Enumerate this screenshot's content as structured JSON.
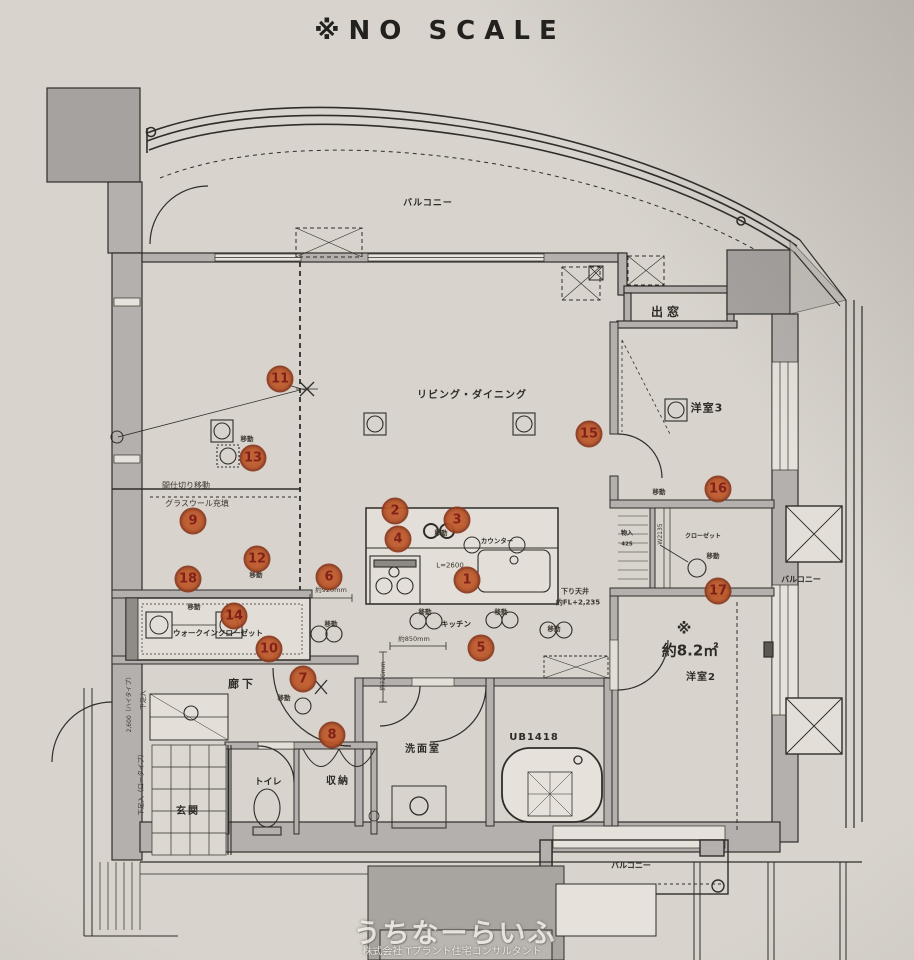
{
  "meta": {
    "scale_note": "※NO SCALE"
  },
  "colors": {
    "paper": "#d8d4cd",
    "line": "#2f2d29",
    "wall_fill": "#b4b0ad",
    "marker_fill": "#c05a2b",
    "marker_ring": "#8a3a1f",
    "marker_number": "#7a150d",
    "watermark_text": "#f0ede8"
  },
  "watermark": {
    "line1": "うちなーらいふ",
    "line2": "株式会社 Tプラント住宅コンサルタント"
  },
  "rooms": [
    {
      "id": "balcony-top",
      "text": "バルコニー",
      "x": 428,
      "y": 204,
      "fs": 9,
      "ls": 1
    },
    {
      "id": "living-dining",
      "text": "リビング・ダイニング",
      "x": 472,
      "y": 396,
      "fs": 10,
      "ls": 1
    },
    {
      "id": "bay-window",
      "text": "出窓",
      "x": 667,
      "y": 312,
      "fs": 12,
      "ls": 4,
      "bold": true
    },
    {
      "id": "western-room-3",
      "text": "洋室3",
      "x": 707,
      "y": 408,
      "fs": 11,
      "ls": 1
    },
    {
      "id": "balcony-right",
      "text": "バルコニー",
      "x": 801,
      "y": 580,
      "fs": 8
    },
    {
      "id": "area-mark",
      "text": "※",
      "x": 684,
      "y": 629,
      "fs": 15,
      "bold": true
    },
    {
      "id": "area-size",
      "text": "約8.2㎡",
      "x": 690,
      "y": 651,
      "fs": 15,
      "bold": true
    },
    {
      "id": "western-room-2",
      "text": "洋室2",
      "x": 701,
      "y": 678,
      "fs": 10,
      "ls": 1
    },
    {
      "id": "hallway",
      "text": "廊下",
      "x": 242,
      "y": 684,
      "fs": 11,
      "ls": 3
    },
    {
      "id": "toilet",
      "text": "トイレ",
      "x": 268,
      "y": 783,
      "fs": 9
    },
    {
      "id": "storage",
      "text": "収納",
      "x": 338,
      "y": 782,
      "fs": 10,
      "ls": 2,
      "bold": true
    },
    {
      "id": "entrance",
      "text": "玄関",
      "x": 188,
      "y": 812,
      "fs": 10,
      "ls": 2
    },
    {
      "id": "washroom",
      "text": "洗面室",
      "x": 423,
      "y": 750,
      "fs": 10,
      "ls": 2
    },
    {
      "id": "unit-bath",
      "text": "UB1418",
      "x": 534,
      "y": 738,
      "fs": 10,
      "ls": 1,
      "bold": true
    },
    {
      "id": "kitchen",
      "text": "キッチン",
      "x": 456,
      "y": 624,
      "fs": 7.5
    },
    {
      "id": "counter",
      "text": "カウンター",
      "x": 497,
      "y": 541,
      "fs": 6.5
    },
    {
      "id": "walk-in-closet",
      "text": "ウォークインクローゼット",
      "x": 218,
      "y": 633,
      "fs": 7.5
    },
    {
      "id": "closet",
      "text": "クローゼット",
      "x": 703,
      "y": 537,
      "fs": 6
    },
    {
      "id": "cabinet",
      "text": "物入",
      "x": 627,
      "y": 534,
      "fs": 6
    },
    {
      "id": "cabinet-size",
      "text": "425",
      "x": 627,
      "y": 545,
      "fs": 5.5
    },
    {
      "id": "balcony-bottom",
      "text": "バルコニー",
      "x": 631,
      "y": 866,
      "fs": 8
    }
  ],
  "annotations": [
    {
      "id": "partition-note",
      "text": "間仕切り移動",
      "x": 186,
      "y": 486,
      "fs": 8
    },
    {
      "id": "glasswool-note",
      "text": "グラスウール充填",
      "x": 197,
      "y": 504,
      "fs": 8
    },
    {
      "id": "ceiling-note-1",
      "text": "下り天井",
      "x": 575,
      "y": 592,
      "fs": 7,
      "bold": true
    },
    {
      "id": "ceiling-note-2",
      "text": "約FL+2,235",
      "x": 578,
      "y": 603,
      "fs": 7,
      "bold": true
    },
    {
      "id": "counter-length",
      "text": "L=2600",
      "x": 450,
      "y": 566,
      "fs": 7
    },
    {
      "id": "dim-920",
      "text": "約920mm",
      "x": 331,
      "y": 590,
      "fs": 6.5
    },
    {
      "id": "dim-850",
      "text": "約850mm",
      "x": 414,
      "y": 639,
      "fs": 6.5
    },
    {
      "id": "dim-720",
      "text": "約720mm",
      "x": 384,
      "y": 676,
      "fs": 6,
      "rot": -90
    },
    {
      "id": "closet-width",
      "text": "W2135",
      "x": 661,
      "y": 534,
      "fs": 6,
      "rot": -90
    },
    {
      "id": "shoe-cabinet-high-size",
      "text": "2,600（ハイタイプ）",
      "x": 130,
      "y": 703,
      "fs": 6,
      "rot": -90
    },
    {
      "id": "shoe-cabinet-high",
      "text": "下足入",
      "x": 143,
      "y": 700,
      "fs": 6.5,
      "rot": -90
    },
    {
      "id": "shoe-cabinet-low",
      "text": "下足入（ロータイプ）",
      "x": 141,
      "y": 783,
      "fs": 6.5,
      "rot": -90
    }
  ],
  "move_text": "移動",
  "move_labels": [
    {
      "x": 247,
      "y": 439
    },
    {
      "x": 256,
      "y": 575
    },
    {
      "x": 194,
      "y": 607
    },
    {
      "x": 284,
      "y": 698
    },
    {
      "x": 331,
      "y": 624
    },
    {
      "x": 441,
      "y": 533
    },
    {
      "x": 425,
      "y": 612
    },
    {
      "x": 501,
      "y": 612
    },
    {
      "x": 554,
      "y": 629
    },
    {
      "x": 713,
      "y": 556
    },
    {
      "x": 659,
      "y": 492
    }
  ],
  "markers": [
    {
      "n": "1",
      "x": 467,
      "y": 580
    },
    {
      "n": "2",
      "x": 395,
      "y": 511
    },
    {
      "n": "3",
      "x": 457,
      "y": 520
    },
    {
      "n": "4",
      "x": 398,
      "y": 539
    },
    {
      "n": "5",
      "x": 481,
      "y": 648
    },
    {
      "n": "6",
      "x": 329,
      "y": 577
    },
    {
      "n": "7",
      "x": 303,
      "y": 679
    },
    {
      "n": "8",
      "x": 332,
      "y": 735
    },
    {
      "n": "9",
      "x": 193,
      "y": 521
    },
    {
      "n": "10",
      "x": 269,
      "y": 649
    },
    {
      "n": "11",
      "x": 280,
      "y": 379
    },
    {
      "n": "12",
      "x": 257,
      "y": 559
    },
    {
      "n": "13",
      "x": 253,
      "y": 458
    },
    {
      "n": "14",
      "x": 234,
      "y": 616
    },
    {
      "n": "15",
      "x": 589,
      "y": 434
    },
    {
      "n": "16",
      "x": 718,
      "y": 489
    },
    {
      "n": "17",
      "x": 718,
      "y": 591
    },
    {
      "n": "18",
      "x": 188,
      "y": 579
    }
  ]
}
